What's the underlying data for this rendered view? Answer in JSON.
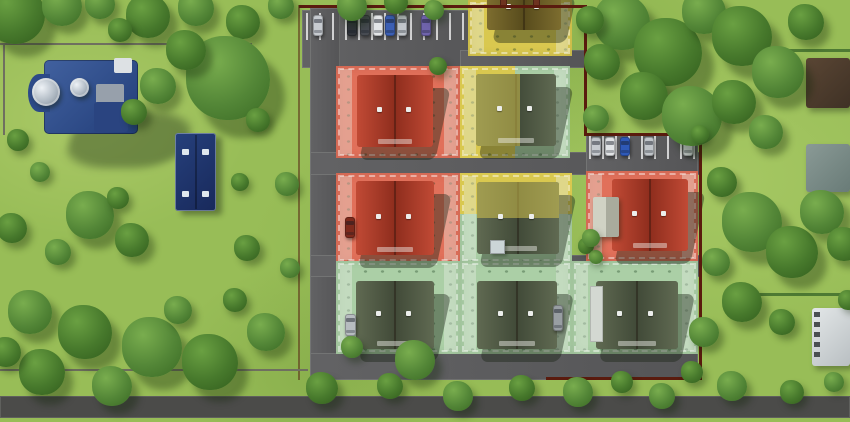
{
  "canvas": {
    "width": 850,
    "height": 422
  },
  "palette": {
    "grass": "#98bd57",
    "tree_dark": "#3c6b26",
    "tree_mid": "#4f8232",
    "asphalt": "#5a5a5c",
    "asphalt_public": "#4b4b49",
    "stall_line": "#ffffff",
    "fence_boundary": "#5a1b0e",
    "fence_gray": "#6f6f60",
    "hedge": "#4e7a33",
    "status_red": "#e1705a",
    "status_yellow": "#d9c84f",
    "status_green": "#abcfa6",
    "church_roof": "#33518f",
    "parish_roof": "#1f3a74",
    "dome_silver": "#b9c3cc"
  },
  "roads": [
    {
      "name": "north-parking-apron",
      "x": 302,
      "y": 10,
      "w": 200,
      "h": 58
    },
    {
      "name": "north-connector-road",
      "x": 460,
      "y": 50,
      "w": 126,
      "h": 18
    },
    {
      "name": "west-access-road",
      "x": 310,
      "y": 8,
      "w": 30,
      "h": 372
    },
    {
      "name": "cross-road-upper",
      "x": 310,
      "y": 152,
      "w": 390,
      "h": 23
    },
    {
      "name": "east-parking-apron",
      "x": 586,
      "y": 134,
      "w": 112,
      "h": 42
    },
    {
      "name": "cross-road-lower",
      "x": 310,
      "y": 255,
      "w": 390,
      "h": 22
    },
    {
      "name": "south-internal-road",
      "x": 310,
      "y": 353,
      "w": 388,
      "h": 27
    },
    {
      "name": "public-road-south",
      "x": 0,
      "y": 396,
      "w": 850,
      "h": 22,
      "variant": "public"
    }
  ],
  "parking": [
    {
      "name": "parking-north",
      "cars_y": 15,
      "car_w": 10,
      "car_h": 21,
      "lines": {
        "x0": 306,
        "x1": 462,
        "step": 13,
        "y": 13,
        "h": 27
      },
      "cars": [
        {
          "x": 313,
          "color": "#c7cbd0"
        },
        {
          "x": 347,
          "color": "#31343a"
        },
        {
          "x": 360,
          "color": "#474b52"
        },
        {
          "x": 373,
          "color": "#e4e6e8"
        },
        {
          "x": 385,
          "color": "#3c5fb4"
        },
        {
          "x": 397,
          "color": "#c2c6cb"
        },
        {
          "x": 421,
          "color": "#6f63ab"
        }
      ]
    },
    {
      "name": "parking-east",
      "cars_y": 137,
      "car_w": 10,
      "car_h": 19,
      "lines": {
        "x0": 589,
        "x1": 697,
        "step": 13,
        "y": 135,
        "h": 24
      },
      "cars": [
        {
          "x": 591,
          "color": "#c5c9ce"
        },
        {
          "x": 605,
          "color": "#e2e4e6"
        },
        {
          "x": 620,
          "color": "#2e59b8"
        },
        {
          "x": 644,
          "color": "#c0c4c9"
        },
        {
          "x": 683,
          "color": "#ced2d4"
        }
      ]
    }
  ],
  "lots": [
    {
      "name": "lot-top-yellow",
      "x": 468,
      "y": 0,
      "w": 104,
      "h": 56,
      "overlay": "yellow"
    },
    {
      "name": "lot-row1-west-red",
      "x": 336,
      "y": 66,
      "w": 124,
      "h": 92,
      "overlay": "red"
    },
    {
      "name": "lot-row1-mid-split",
      "x": 460,
      "y": 66,
      "w": 110,
      "h": 92,
      "overlay": "green",
      "split": {
        "dir": "v",
        "frac": 0.5,
        "color": "yellow"
      }
    },
    {
      "name": "lot-row2-west-red",
      "x": 336,
      "y": 173,
      "w": 124,
      "h": 90,
      "overlay": "red"
    },
    {
      "name": "lot-row2-mid-split",
      "x": 460,
      "y": 173,
      "w": 112,
      "h": 90,
      "overlay": "green",
      "split": {
        "dir": "h",
        "frac": 0.45,
        "color": "yellow"
      }
    },
    {
      "name": "lot-row2-east-red",
      "x": 586,
      "y": 171,
      "w": 112,
      "h": 90,
      "overlay": "red"
    },
    {
      "name": "lot-row3-west-green",
      "x": 336,
      "y": 261,
      "w": 124,
      "h": 93,
      "overlay": "green"
    },
    {
      "name": "lot-row3-mid-green",
      "x": 460,
      "y": 261,
      "w": 112,
      "h": 93,
      "overlay": "green"
    },
    {
      "name": "lot-row3-east-green",
      "x": 572,
      "y": 261,
      "w": 126,
      "h": 93,
      "overlay": "green"
    }
  ],
  "houses": [
    {
      "name": "duplex-top",
      "x": 487,
      "y": -16,
      "w": 74,
      "h": 46,
      "roof": "brown",
      "chimneys": true
    },
    {
      "name": "duplex-row1-west",
      "x": 357,
      "y": 75,
      "w": 76,
      "h": 72,
      "roof": "red"
    },
    {
      "name": "duplex-row1-mid",
      "x": 476,
      "y": 74,
      "w": 80,
      "h": 72,
      "roof": "green",
      "tint": {
        "side": "left",
        "frac": 0.55
      }
    },
    {
      "name": "duplex-row2-west",
      "x": 356,
      "y": 181,
      "w": 78,
      "h": 74,
      "roof": "red"
    },
    {
      "name": "duplex-row2-mid",
      "x": 477,
      "y": 182,
      "w": 82,
      "h": 72,
      "roof": "green",
      "tint": {
        "side": "top",
        "frac": 0.5
      }
    },
    {
      "name": "duplex-row2-east",
      "x": 612,
      "y": 179,
      "w": 76,
      "h": 72,
      "roof": "red"
    },
    {
      "name": "duplex-row3-west",
      "x": 356,
      "y": 281,
      "w": 78,
      "h": 68,
      "roof": "green"
    },
    {
      "name": "duplex-row3-mid",
      "x": 477,
      "y": 281,
      "w": 80,
      "h": 68,
      "roof": "green"
    },
    {
      "name": "duplex-row3-east",
      "x": 596,
      "y": 281,
      "w": 82,
      "h": 68,
      "roof": "green"
    }
  ],
  "structures": [
    {
      "name": "old-cottage",
      "x": 593,
      "y": 197,
      "w": 26,
      "h": 40,
      "style": "cottage"
    },
    {
      "name": "garden-shed",
      "x": 490,
      "y": 240,
      "w": 15,
      "h": 14,
      "style": "shed"
    },
    {
      "name": "house-side-annex",
      "x": 590,
      "y": 286,
      "w": 13,
      "h": 56,
      "style": "annex"
    }
  ],
  "church": {
    "name": "church",
    "shadow": {
      "x": 70,
      "y": 112,
      "w": 118,
      "h": 56
    },
    "roof_main": {
      "x": 44,
      "y": 60,
      "w": 94,
      "h": 74
    },
    "apse": {
      "x": 28,
      "y": 74,
      "w": 22,
      "h": 38
    },
    "annex": {
      "x": 96,
      "y": 84,
      "w": 28,
      "h": 36
    },
    "white_block": {
      "x": 114,
      "y": 58,
      "w": 18,
      "h": 15
    },
    "wing": {
      "x": 94,
      "y": 102,
      "w": 34,
      "h": 30
    },
    "dome_large": {
      "x": 32,
      "y": 78,
      "d": 28
    },
    "dome_small": {
      "x": 70,
      "y": 78,
      "d": 19
    }
  },
  "parish": {
    "name": "parish-outbuilding",
    "x": 175,
    "y": 133,
    "w": 41,
    "h": 78,
    "skylights": 4
  },
  "neighbors": [
    {
      "name": "neighbor-house-brown-roof",
      "x": 806,
      "y": 58,
      "w": 44,
      "h": 50,
      "c1": "#5a4634",
      "c2": "#3f3125"
    },
    {
      "name": "neighbor-house-teal-roof",
      "x": 806,
      "y": 144,
      "w": 44,
      "h": 48,
      "c1": "#8a9a96",
      "c2": "#697b77"
    },
    {
      "name": "neighbor-house-white",
      "x": 812,
      "y": 308,
      "w": 38,
      "h": 58,
      "c1": "#e3e7e8",
      "c2": "#b9bfc2"
    }
  ],
  "fences": [
    {
      "name": "boundary-north",
      "x": 299,
      "y": 5,
      "w": 288,
      "h": 3
    },
    {
      "name": "boundary-east-upper",
      "x": 584,
      "y": 5,
      "w": 3,
      "h": 131
    },
    {
      "name": "boundary-jog-east",
      "x": 584,
      "y": 133,
      "w": 118,
      "h": 3
    },
    {
      "name": "boundary-east-lower",
      "x": 699,
      "y": 133,
      "w": 3,
      "h": 247
    },
    {
      "name": "boundary-south",
      "x": 546,
      "y": 377,
      "w": 156,
      "h": 3
    },
    {
      "name": "boundary-west",
      "x": 298,
      "y": 5,
      "w": 2,
      "h": 375,
      "light": true
    },
    {
      "name": "churchyard-fence-north",
      "x": 0,
      "y": 43,
      "w": 252,
      "h": 2,
      "gray": true
    },
    {
      "name": "churchyard-fence-west",
      "x": 3,
      "y": 43,
      "w": 2,
      "h": 92,
      "gray": true
    },
    {
      "name": "field-fence-southwest",
      "x": 0,
      "y": 369,
      "w": 308,
      "h": 2,
      "gray": true
    },
    {
      "name": "hedge-east-1",
      "x": 788,
      "y": 49,
      "w": 62,
      "h": 3,
      "hedge": true
    },
    {
      "name": "hedge-east-2",
      "x": 756,
      "y": 293,
      "w": 94,
      "h": 3,
      "hedge": true
    }
  ],
  "vehicles": [
    {
      "name": "parked-car-red",
      "x": 345,
      "y": 217,
      "w": 10,
      "h": 21,
      "color": "#7e2a1c"
    },
    {
      "name": "parked-car-silver",
      "x": 345,
      "y": 314,
      "w": 11,
      "h": 22,
      "color": "#b7bcc0"
    },
    {
      "name": "parked-car-gray",
      "x": 553,
      "y": 305,
      "w": 10,
      "h": 26,
      "color": "#989ea2"
    }
  ],
  "trees": [
    [
      15,
      14,
      30,
      0
    ],
    [
      62,
      6,
      20,
      1
    ],
    [
      100,
      4,
      15,
      1
    ],
    [
      148,
      16,
      22,
      0
    ],
    [
      196,
      8,
      18,
      1
    ],
    [
      243,
      22,
      17,
      0
    ],
    [
      281,
      6,
      13,
      1
    ],
    [
      120,
      30,
      12,
      0
    ],
    [
      228,
      78,
      42,
      1
    ],
    [
      186,
      50,
      20,
      0
    ],
    [
      258,
      120,
      12,
      0
    ],
    [
      158,
      86,
      18,
      1
    ],
    [
      134,
      112,
      13,
      0
    ],
    [
      18,
      140,
      11,
      0
    ],
    [
      40,
      172,
      10,
      1
    ],
    [
      90,
      215,
      24,
      1
    ],
    [
      132,
      240,
      17,
      0
    ],
    [
      58,
      252,
      13,
      1
    ],
    [
      12,
      228,
      15,
      0
    ],
    [
      118,
      198,
      11,
      0
    ],
    [
      240,
      182,
      9,
      0
    ],
    [
      287,
      184,
      12,
      1
    ],
    [
      247,
      248,
      13,
      0
    ],
    [
      290,
      268,
      10,
      1
    ],
    [
      30,
      312,
      22,
      1
    ],
    [
      85,
      332,
      27,
      0
    ],
    [
      152,
      347,
      30,
      1
    ],
    [
      42,
      372,
      23,
      0
    ],
    [
      112,
      386,
      20,
      1
    ],
    [
      210,
      362,
      28,
      0
    ],
    [
      266,
      332,
      19,
      1
    ],
    [
      6,
      352,
      15,
      0
    ],
    [
      178,
      310,
      14,
      1
    ],
    [
      235,
      300,
      12,
      0
    ],
    [
      322,
      388,
      16,
      0
    ],
    [
      352,
      347,
      11,
      1
    ],
    [
      415,
      360,
      20,
      1
    ],
    [
      390,
      386,
      13,
      0
    ],
    [
      458,
      396,
      15,
      1
    ],
    [
      522,
      388,
      13,
      0
    ],
    [
      578,
      392,
      15,
      1
    ],
    [
      622,
      382,
      11,
      0
    ],
    [
      662,
      396,
      13,
      1
    ],
    [
      692,
      372,
      11,
      0
    ],
    [
      732,
      386,
      15,
      1
    ],
    [
      792,
      392,
      12,
      0
    ],
    [
      834,
      382,
      10,
      1
    ],
    [
      352,
      6,
      15,
      1
    ],
    [
      396,
      2,
      12,
      0
    ],
    [
      434,
      10,
      10,
      1
    ],
    [
      438,
      66,
      9,
      0
    ],
    [
      622,
      22,
      28,
      1
    ],
    [
      668,
      52,
      34,
      0
    ],
    [
      704,
      12,
      22,
      1
    ],
    [
      742,
      36,
      30,
      0
    ],
    [
      778,
      72,
      26,
      1
    ],
    [
      806,
      22,
      18,
      0
    ],
    [
      590,
      20,
      14,
      0
    ],
    [
      644,
      96,
      24,
      0
    ],
    [
      692,
      116,
      30,
      1
    ],
    [
      734,
      102,
      22,
      0
    ],
    [
      766,
      132,
      17,
      1
    ],
    [
      602,
      62,
      18,
      0
    ],
    [
      596,
      118,
      13,
      1
    ],
    [
      722,
      182,
      15,
      0
    ],
    [
      752,
      222,
      30,
      1
    ],
    [
      792,
      252,
      26,
      0
    ],
    [
      716,
      262,
      14,
      1
    ],
    [
      742,
      302,
      20,
      0
    ],
    [
      704,
      332,
      15,
      1
    ],
    [
      782,
      322,
      13,
      0
    ],
    [
      822,
      212,
      22,
      1
    ],
    [
      844,
      244,
      17,
      0
    ],
    [
      848,
      300,
      10,
      0
    ],
    [
      586,
      246,
      8,
      0
    ],
    [
      596,
      257,
      7,
      1
    ],
    [
      700,
      134,
      9,
      0
    ],
    [
      591,
      238,
      9,
      1
    ]
  ]
}
